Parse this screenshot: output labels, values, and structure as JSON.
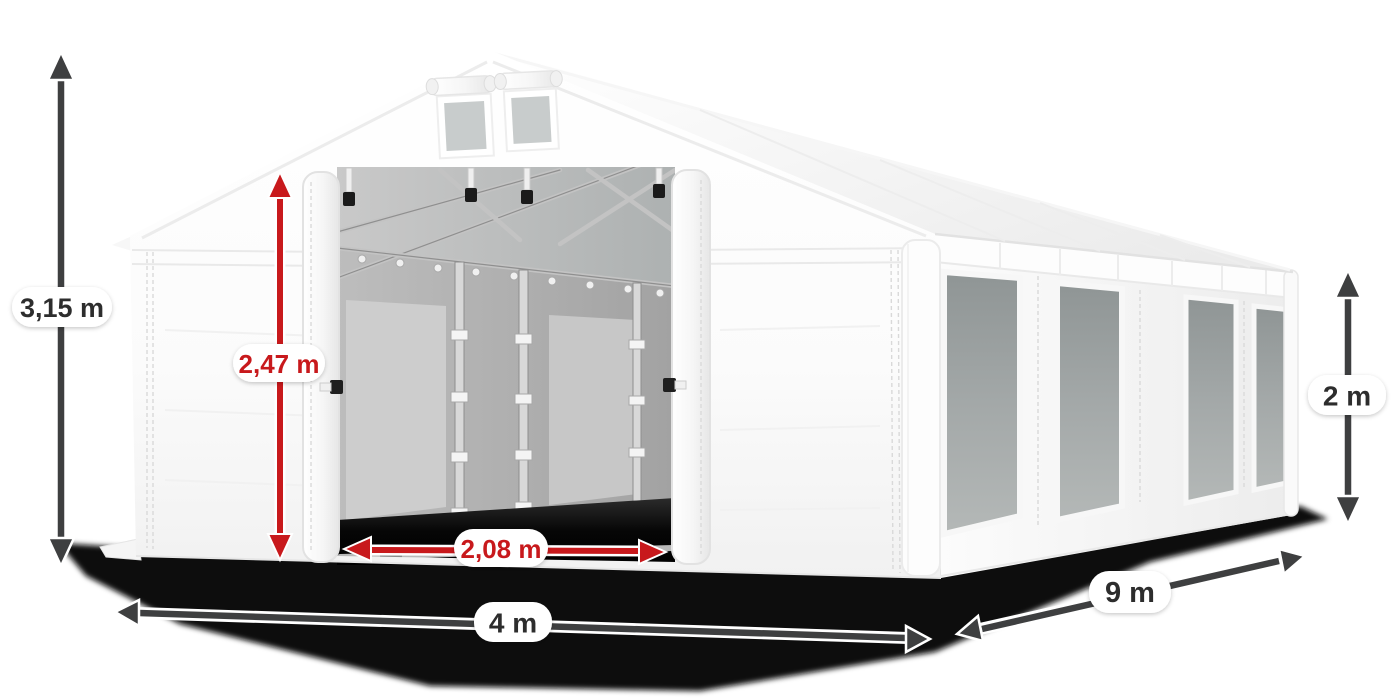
{
  "dimensions": {
    "total_height": "3,15 m",
    "entrance_height": "2,47 m",
    "entrance_width": "2,08 m",
    "front_width": "4 m",
    "side_length": "9 m",
    "side_wall_height": "2 m"
  },
  "colors": {
    "dimension_red": "#c8191c",
    "dimension_dark": "#3e3f40",
    "label_text_dark": "#2d2d2d",
    "tent_white": "#fcfcfc",
    "side_window_gray": "#9aa0a0",
    "interior_gray": "#b2b2b2",
    "shadow_black": "#0a0a0a",
    "background": "#ffffff"
  }
}
